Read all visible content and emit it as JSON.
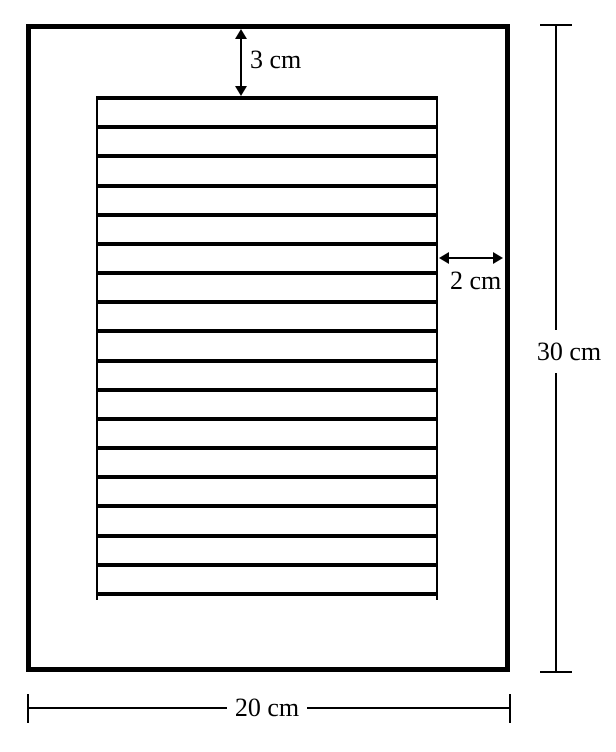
{
  "diagram": {
    "description": "Page margin diagram: a rectangular sheet with a ruled writing area and dimension annotations",
    "labels": {
      "top_margin": "3 cm",
      "right_margin": "2 cm",
      "page_height": "30 cm",
      "page_width": "20 cm"
    },
    "dimensions_cm": {
      "top_margin": 3,
      "right_margin": 2,
      "page_height": 30,
      "page_width": 20
    },
    "ruled_lines_count": 18,
    "colors": {
      "line": "#000000",
      "background": "#ffffff"
    }
  }
}
